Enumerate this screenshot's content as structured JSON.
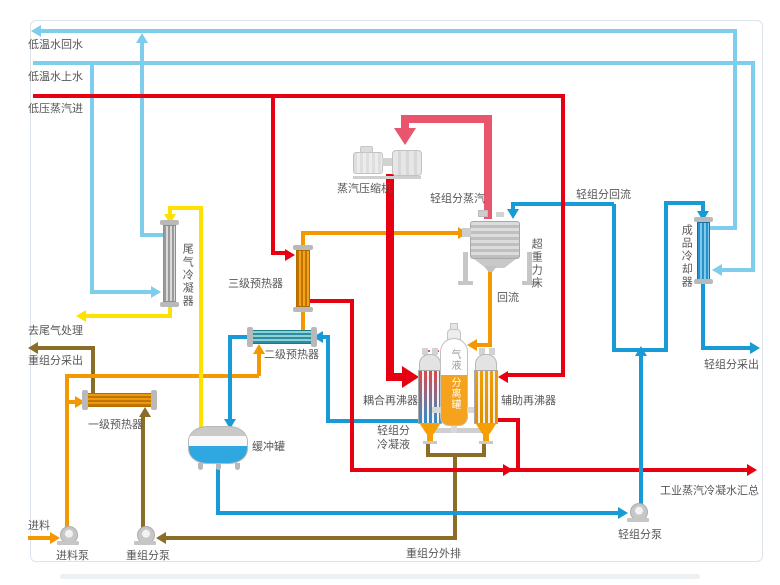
{
  "colors": {
    "cooling_water": "#7ecdec",
    "process_blue": "#189ad6",
    "steam_red": "#e60012",
    "vapor_crimson": "#e8556c",
    "feed_orange": "#f39800",
    "tail_gas_yellow": "#ffe100",
    "heavy_olive": "#8a6d26",
    "label_gray": "#595757"
  },
  "streams": {
    "cold_water_return": "低温水回水",
    "cold_water_supply": "低温水上水",
    "lp_steam_in": "低压蒸汽进",
    "to_tail_gas_treatment": "去尾气处理",
    "heavy_component_drawoff": "重组分采出",
    "light_component_vapor": "轻组分蒸汽",
    "light_component_reflux": "轻组分回流",
    "reflux": "回流",
    "light_component_drawoff": "轻组分采出",
    "light_component_condensate_l1": "轻组分",
    "light_component_condensate_l2": "冷凝液",
    "industrial_steam_condensate": "工业蒸汽冷凝水汇总",
    "heavy_component_discharge": "重组分外排",
    "feed": "进料"
  },
  "equipment": {
    "tail_gas_condenser": "尾气冷凝器",
    "preheater_1": "一级预热器",
    "preheater_2": "二级预热器",
    "preheater_3": "三级预热器",
    "buffer_tank": "缓冲罐",
    "steam_compressor": "蒸汽压缩机",
    "higee_bed": "超重力床",
    "product_cooler": "成品冷却器",
    "coupled_reboiler": "耦合再沸器",
    "auxiliary_reboiler": "辅助再沸器",
    "separator_label_top": "气液",
    "separator_label_bottom": "分离罐",
    "feed_pump": "进料泵",
    "heavy_component_pump": "重组分泵",
    "light_component_pump": "轻组分泵"
  },
  "watermark": {
    "letters": "AG",
    "cn": "亚光股份",
    "en": "YAGUANG TECH"
  }
}
